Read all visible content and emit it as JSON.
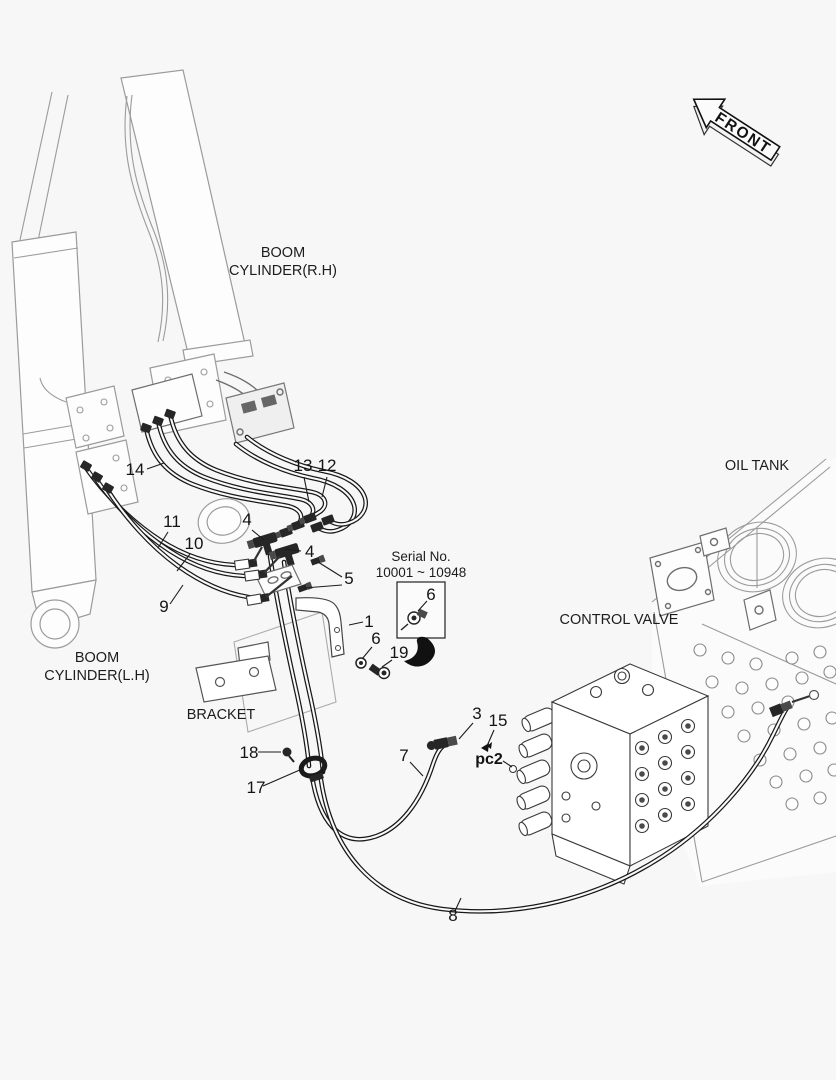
{
  "colors": {
    "background": "#f7f7f7",
    "ink": "#1c1c1c",
    "light_line": "#9b9b9b"
  },
  "labels": {
    "front": "FRONT",
    "boom_cylinder_rh_line1": "BOOM",
    "boom_cylinder_rh_line2": "CYLINDER(R.H)",
    "boom_cylinder_lh_line1": "BOOM",
    "boom_cylinder_lh_line2": "CYLINDER(L.H)",
    "oil_tank": "OIL TANK",
    "control_valve": "CONTROL VALVE",
    "bracket": "BRACKET",
    "serial_line1": "Serial No.",
    "serial_line2": "10001 ~ 10948",
    "port_pc2": "pc2"
  },
  "callouts": {
    "n1": "1",
    "n3": "3",
    "n4": "4",
    "n5": "5",
    "n6": "6",
    "n7": "7",
    "n8": "8",
    "n9": "9",
    "n10": "10",
    "n11": "11",
    "n12": "12",
    "n13": "13",
    "n14": "14",
    "n15": "15",
    "n17": "17",
    "n18": "18",
    "n19": "19"
  }
}
